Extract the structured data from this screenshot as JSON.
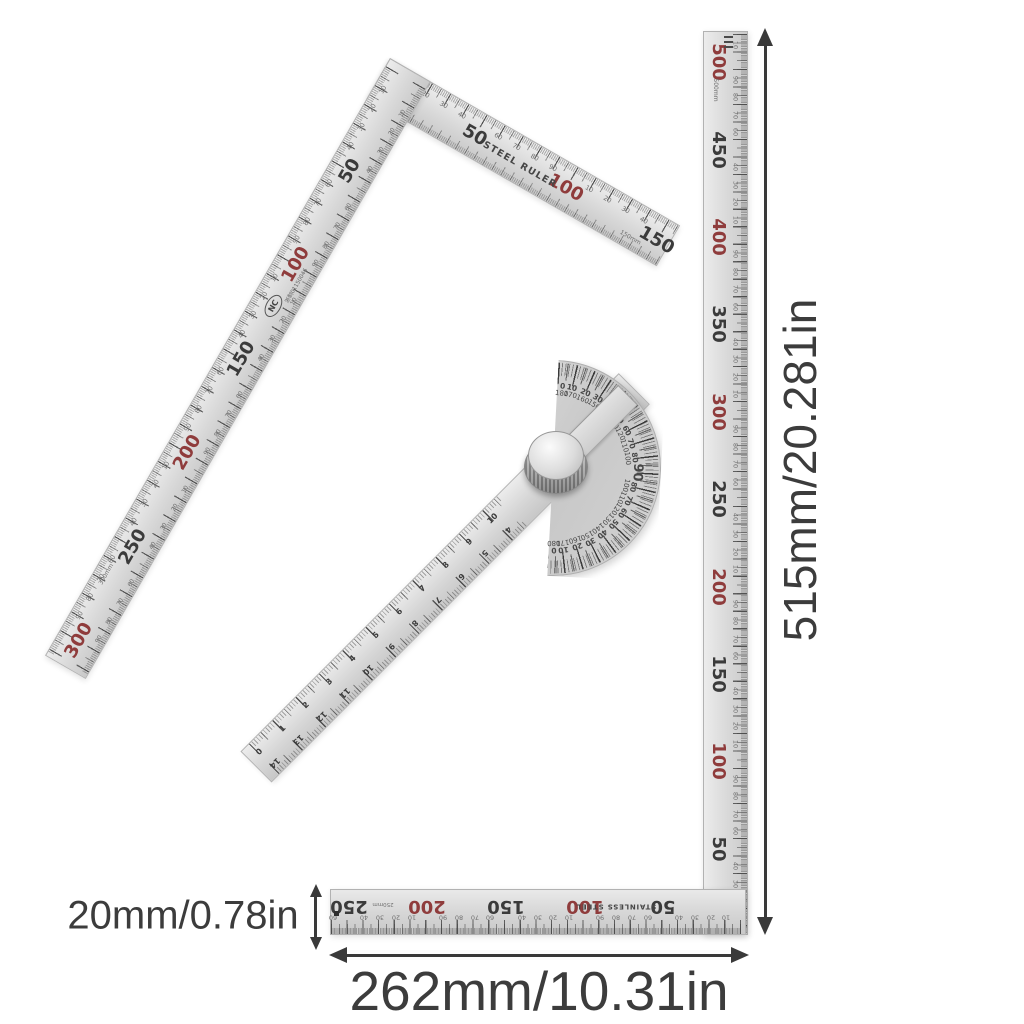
{
  "colors": {
    "red": "#8f3c3c",
    "dark": "#3b3b3b",
    "minor": "#6f6f6f",
    "annotation": "#3c3c3c"
  },
  "annotations": {
    "height_label": "515mm/20.281in",
    "width_label": "262mm/10.31in",
    "thickness_label": "20mm/0.78in"
  },
  "minor_cycle": [
    "10",
    "20",
    "30",
    "40",
    "60",
    "70",
    "80",
    "90"
  ],
  "square_small": {
    "brand": "STEEL RULER",
    "logo": "NC",
    "serial": "浙制01150046",
    "long_arm_majors": [
      {
        "t": "50",
        "c": "dark"
      },
      {
        "t": "100",
        "c": "red"
      },
      {
        "t": "150",
        "c": "dark"
      },
      {
        "t": "200",
        "c": "red"
      },
      {
        "t": "250",
        "c": "dark"
      },
      {
        "t": "300",
        "c": "red"
      }
    ],
    "long_arm_size_note": "300mm",
    "short_arm_majors": [
      {
        "t": "50",
        "c": "dark"
      },
      {
        "t": "100",
        "c": "red"
      },
      {
        "t": "150",
        "c": "dark"
      }
    ],
    "short_arm_size_note": "150mm"
  },
  "square_large": {
    "brand": "STAINLESS STEEL",
    "vertical_majors": [
      {
        "t": "500",
        "c": "red"
      },
      {
        "t": "450",
        "c": "dark"
      },
      {
        "t": "400",
        "c": "red"
      },
      {
        "t": "350",
        "c": "dark"
      },
      {
        "t": "300",
        "c": "red"
      },
      {
        "t": "250",
        "c": "dark"
      },
      {
        "t": "200",
        "c": "red"
      },
      {
        "t": "150",
        "c": "dark"
      },
      {
        "t": "100",
        "c": "red"
      },
      {
        "t": "50",
        "c": "dark"
      }
    ],
    "vertical_size_note": "500mm",
    "bottom_majors": [
      {
        "t": "250",
        "c": "dark"
      },
      {
        "t": "200",
        "c": "red"
      },
      {
        "t": "150",
        "c": "dark"
      },
      {
        "t": "100",
        "c": "red"
      },
      {
        "t": "50",
        "c": "dark"
      }
    ],
    "bottom_size_note": "250mm"
  },
  "protractor": {
    "degree_pairs": [
      [
        "0",
        "180"
      ],
      [
        "10",
        "170"
      ],
      [
        "20",
        "160"
      ],
      [
        "30",
        "150"
      ],
      [
        "40",
        "140"
      ],
      [
        "50",
        "130"
      ],
      [
        "60",
        "120"
      ],
      [
        "70",
        "110"
      ],
      [
        "80",
        "100"
      ],
      [
        "90",
        ""
      ],
      [
        "80",
        "100"
      ],
      [
        "70",
        "110"
      ],
      [
        "60",
        "120"
      ],
      [
        "50",
        "130"
      ],
      [
        "40",
        "140"
      ],
      [
        "30",
        "150"
      ],
      [
        "20",
        "160"
      ],
      [
        "10",
        "170"
      ],
      [
        "0",
        "180"
      ]
    ],
    "arm_upper_scale": [
      "0",
      "1",
      "2",
      "3",
      "4",
      "5",
      "6",
      "7",
      "8",
      "9",
      "10"
    ],
    "arm_lower_scale": [
      "14",
      "13",
      "12",
      "11",
      "10",
      "9",
      "8",
      "7",
      "6",
      "5",
      "4"
    ]
  }
}
